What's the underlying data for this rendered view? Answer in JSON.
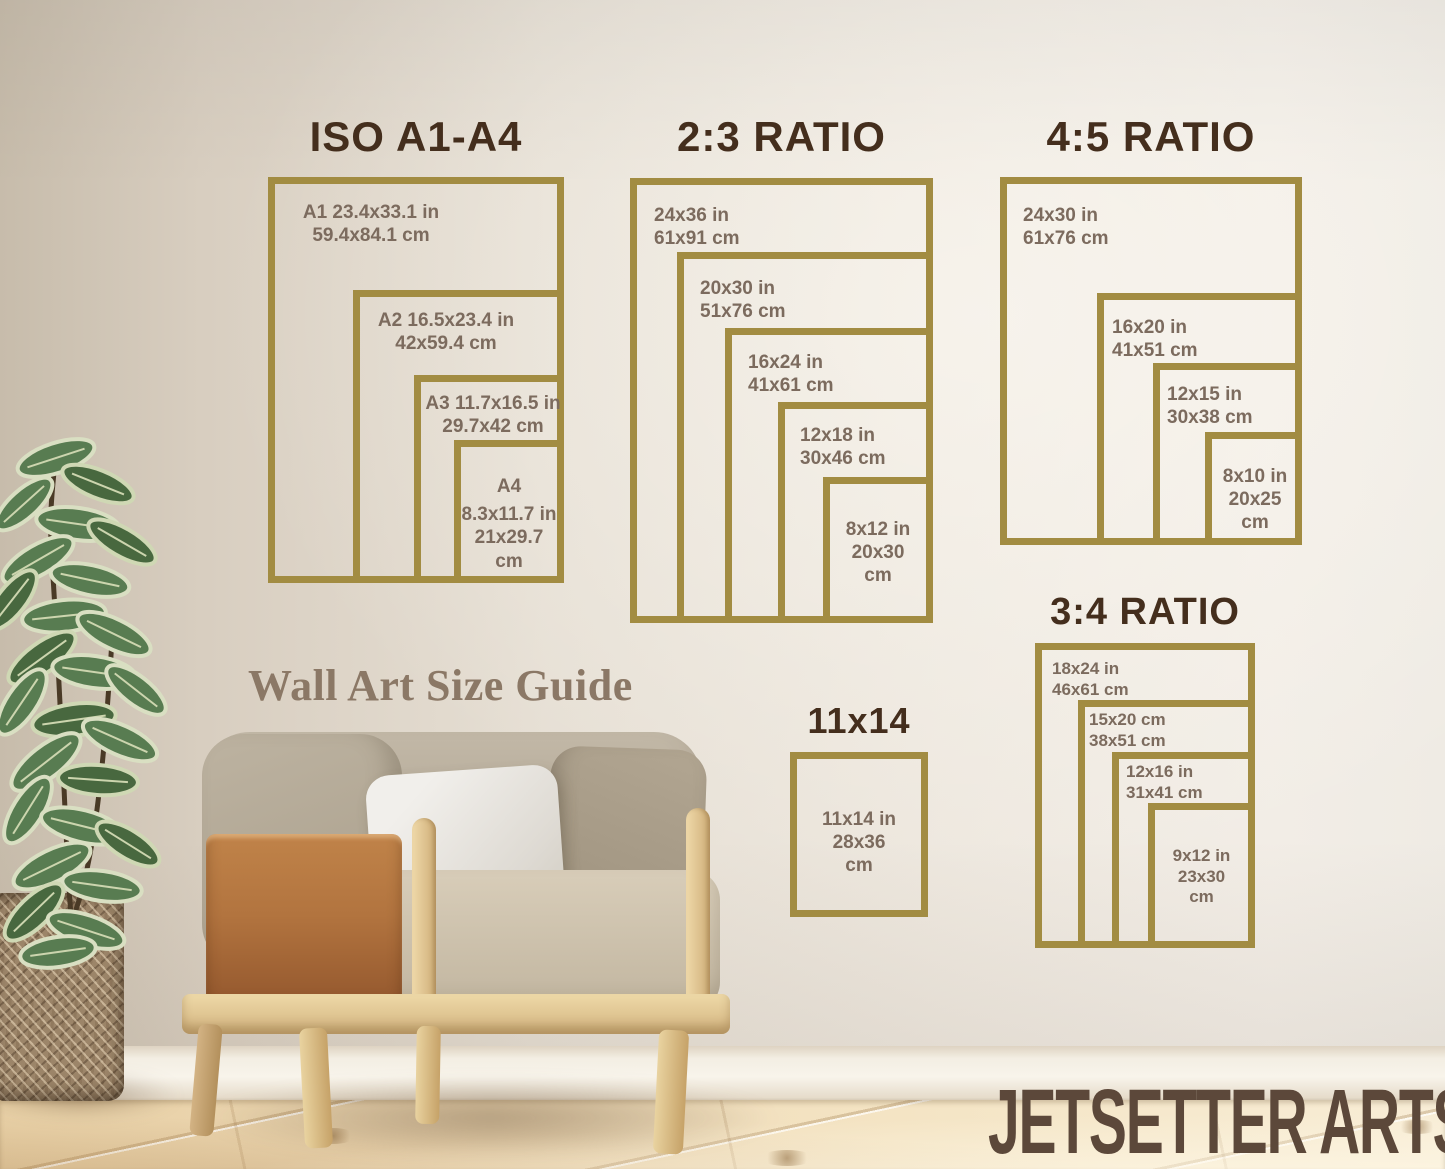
{
  "caption": "Wall Art Size Guide",
  "brand": "JETSETTER ARTS",
  "colors": {
    "frame_gold": "#a28c42",
    "title_brown": "#442e1d",
    "label_brown": "#7c6b5e",
    "caption_brown": "#8b7866",
    "brand_brown": "#5c483a",
    "wall_beige": "#e9e2d8",
    "floor_wood": "#eed9b4"
  },
  "groups": {
    "iso": {
      "title": "ISO A1-A4",
      "frames": [
        {
          "name": "A1",
          "lines": [
            "A1 23.4x33.1 in",
            "59.4x84.1 cm"
          ]
        },
        {
          "name": "A2",
          "lines": [
            "A2 16.5x23.4 in",
            "42x59.4 cm"
          ]
        },
        {
          "name": "A3",
          "lines": [
            "A3 11.7x16.5 in",
            "29.7x42 cm"
          ]
        },
        {
          "name": "A4",
          "lines": [
            "A4",
            "8.3x11.7 in",
            "21x29.7",
            "cm"
          ]
        }
      ]
    },
    "ratio_2_3": {
      "title": "2:3 RATIO",
      "frames": [
        {
          "name": "24x36",
          "lines": [
            "24x36 in",
            "61x91 cm"
          ]
        },
        {
          "name": "20x30",
          "lines": [
            "20x30 in",
            "51x76 cm"
          ]
        },
        {
          "name": "16x24",
          "lines": [
            "16x24 in",
            "41x61 cm"
          ]
        },
        {
          "name": "12x18",
          "lines": [
            "12x18 in",
            "30x46 cm"
          ]
        },
        {
          "name": "8x12",
          "lines": [
            "8x12 in",
            "20x30",
            "cm"
          ]
        }
      ]
    },
    "ratio_4_5": {
      "title": "4:5 RATIO",
      "frames": [
        {
          "name": "24x30",
          "lines": [
            "24x30 in",
            "61x76 cm"
          ]
        },
        {
          "name": "16x20",
          "lines": [
            "16x20 in",
            "41x51 cm"
          ]
        },
        {
          "name": "12x15",
          "lines": [
            "12x15 in",
            "30x38 cm"
          ]
        },
        {
          "name": "8x10",
          "lines": [
            "8x10 in",
            "20x25",
            "cm"
          ]
        }
      ]
    },
    "ratio_3_4": {
      "title": "3:4 RATIO",
      "frames": [
        {
          "name": "18x24",
          "lines": [
            "18x24 in",
            "46x61 cm"
          ]
        },
        {
          "name": "15x20",
          "lines": [
            "15x20 cm",
            "38x51 cm"
          ]
        },
        {
          "name": "12x16",
          "lines": [
            "12x16 in",
            "31x41 cm"
          ]
        },
        {
          "name": "9x12",
          "lines": [
            "9x12 in",
            "23x30",
            "cm"
          ]
        }
      ]
    },
    "s11x14": {
      "title": "11x14",
      "frames": [
        {
          "name": "11x14",
          "lines": [
            "11x14 in",
            "28x36",
            "cm"
          ]
        }
      ]
    }
  }
}
